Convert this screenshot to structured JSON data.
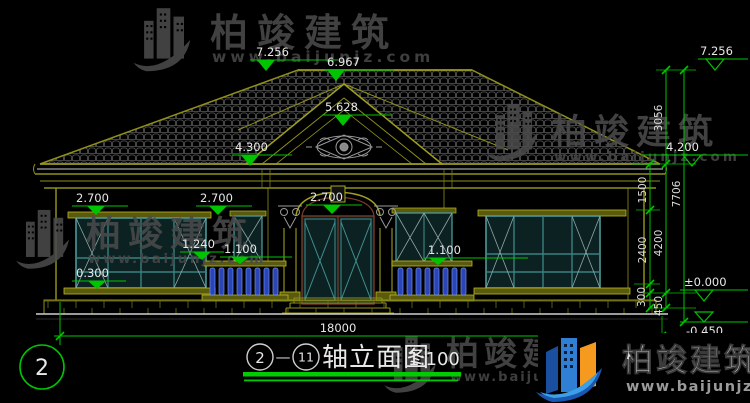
{
  "watermark": {
    "brand": "柏竣建筑",
    "url": "www.baijunjz.com"
  },
  "levels": {
    "ridge_left": "7.256",
    "gable_top": "6.967",
    "pediment": "5.628",
    "eave_wing": "4.300",
    "lintel_left": "2.700",
    "lintel_mid": "2.700",
    "door_arch": "2.700",
    "mid_sill": "1.240",
    "rail_left": "1.100",
    "rail_right": "1.100",
    "sill_left": "0.300",
    "ridge_right": "7.256",
    "eave_right": "4.200",
    "floor_right": "±0.000",
    "ground_right": "-0.450"
  },
  "dims": {
    "roof_rise": "3056",
    "eave_band": "1500",
    "window_band": "2400",
    "sill_band": "300",
    "plinth_band": "450",
    "upper_total": "4200",
    "total_height": "7706",
    "total_width": "18000"
  },
  "axis": {
    "left_bubble": "2"
  },
  "title": {
    "start": "2",
    "sep": "—",
    "end": "11",
    "name": "轴立面图",
    "scale": "1:100"
  }
}
